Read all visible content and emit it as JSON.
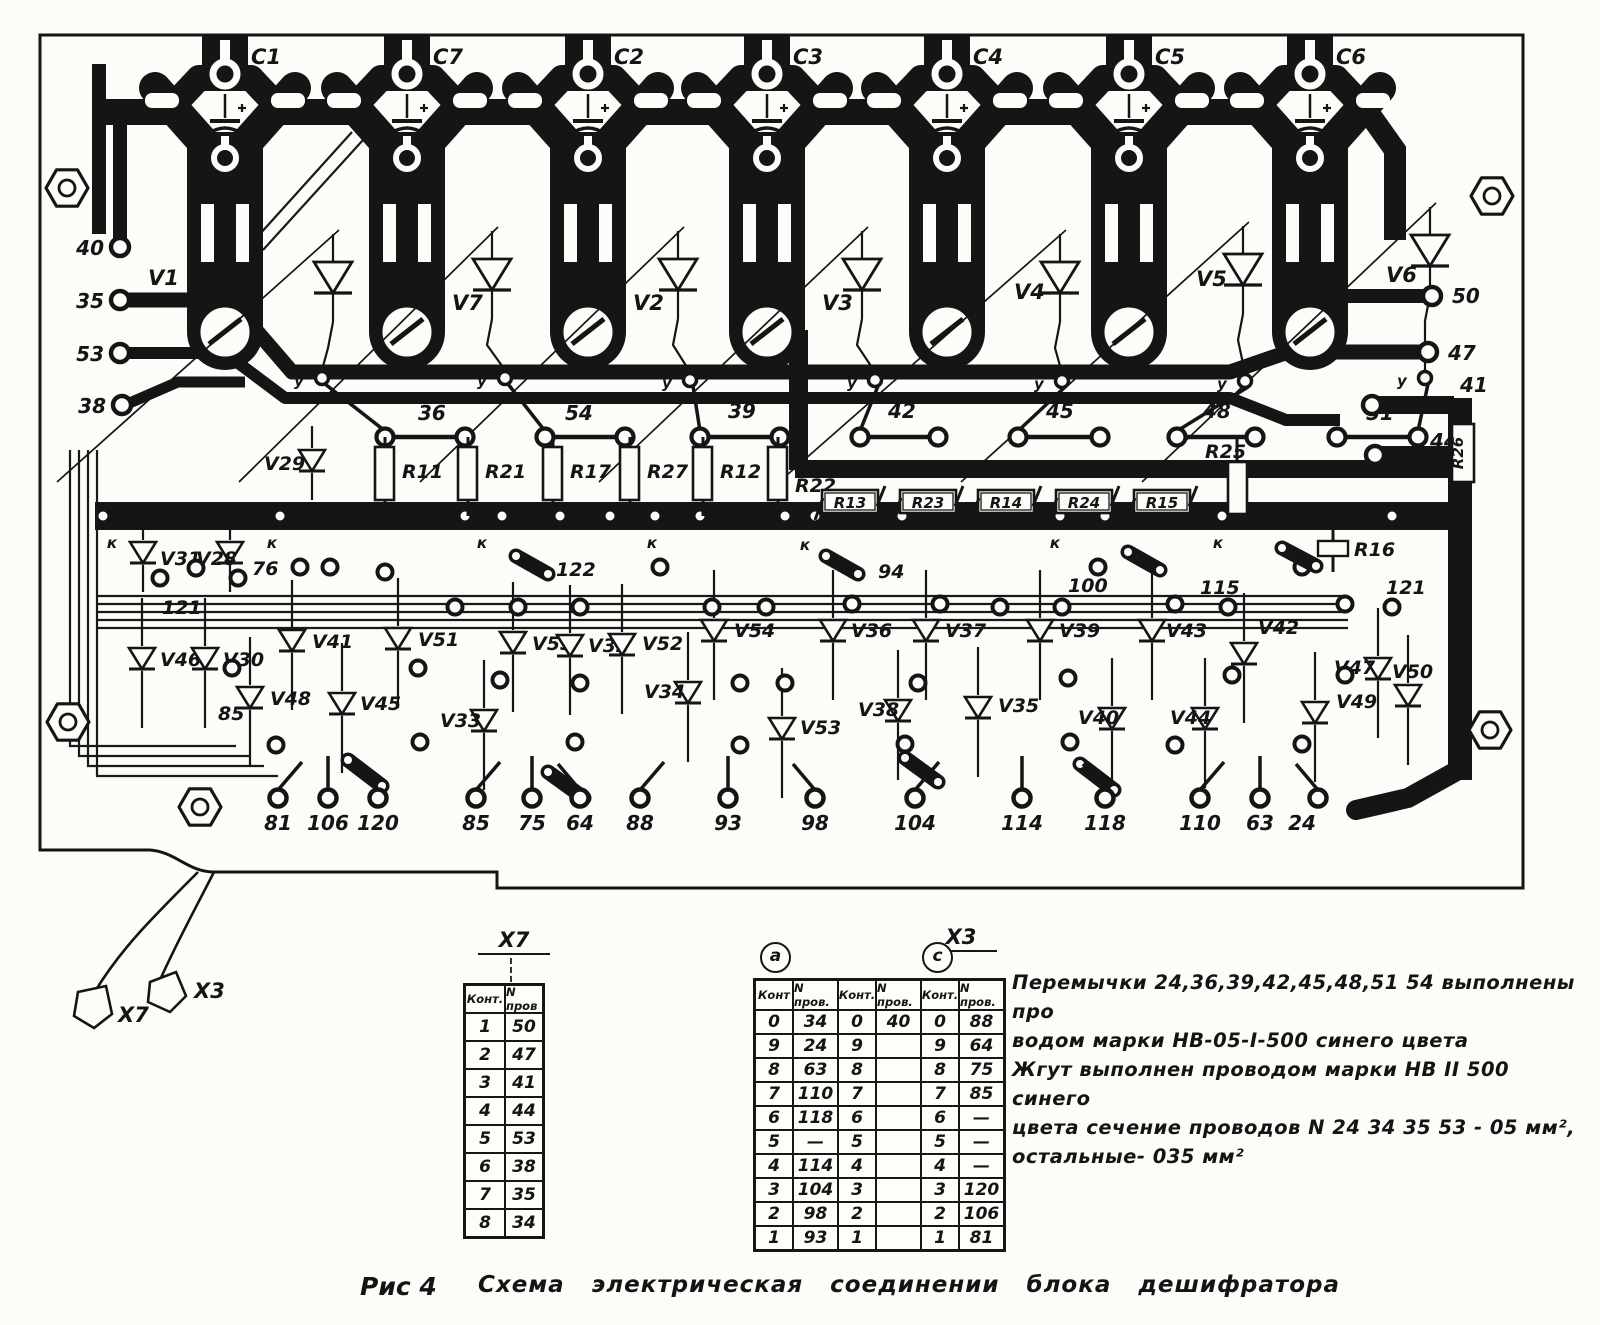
{
  "figure": {
    "fig_label": "Рис 4",
    "caption": "Схема  электрическая  соединении  блока  дешифратора"
  },
  "notes": {
    "line1": "Перемычки  24,36,39,42,45,48,51 54  выполнены  про",
    "line2": "водом  марки   НВ-05-I-500    синего   цвета",
    "line3": "Жгут  выполнен  проводом  марки  НВ II 500  синего",
    "line4": "цвета   сечение  проводов   N 24 34 35   53  - 05 мм²,",
    "line5": "остальные- 035 мм²"
  },
  "connectors": {
    "x7_flag": "X7",
    "x3_flag": "X3"
  },
  "tables": {
    "x7": {
      "title": "X7",
      "headers": [
        "Конт.",
        "N пров"
      ],
      "rows": [
        [
          "1",
          "50"
        ],
        [
          "2",
          "47"
        ],
        [
          "3",
          "41"
        ],
        [
          "4",
          "44"
        ],
        [
          "5",
          "53"
        ],
        [
          "6",
          "38"
        ],
        [
          "7",
          "35"
        ],
        [
          "8",
          "34"
        ]
      ]
    },
    "x3": {
      "title": "X3",
      "group_a": "а",
      "group_c": "с",
      "headers": [
        "Конт",
        "N пров.",
        "Конт.",
        "N пров.",
        "Конт.",
        "N пров."
      ],
      "rows": [
        [
          "0",
          "34",
          "0",
          "40",
          "0",
          "88"
        ],
        [
          "9",
          "24",
          "9",
          "",
          "9",
          "64"
        ],
        [
          "8",
          "63",
          "8",
          "",
          "8",
          "75"
        ],
        [
          "7",
          "110",
          "7",
          "",
          "7",
          "85"
        ],
        [
          "6",
          "118",
          "6",
          "",
          "6",
          "—"
        ],
        [
          "5",
          "—",
          "5",
          "",
          "5",
          "—"
        ],
        [
          "4",
          "114",
          "4",
          "",
          "4",
          "—"
        ],
        [
          "3",
          "104",
          "3",
          "",
          "3",
          "120"
        ],
        [
          "2",
          "98",
          "2",
          "",
          "2",
          "106"
        ],
        [
          "1",
          "93",
          "1",
          "",
          "1",
          "81"
        ]
      ]
    }
  },
  "board": {
    "capacitors": [
      "C1",
      "C7",
      "C2",
      "C3",
      "C4",
      "C5",
      "C6"
    ],
    "thyristors": [
      "V1",
      "V7",
      "V2",
      "V3",
      "V4",
      "V5",
      "V6"
    ],
    "edge_pads_left": [
      "40",
      "35",
      "53",
      "38"
    ],
    "edge_pads_right": [
      "50",
      "47",
      "41",
      "44"
    ],
    "gate": "у",
    "cathode": "к",
    "jumpers": [
      "36",
      "54",
      "39",
      "42",
      "45",
      "48",
      "51"
    ],
    "res_vertical": [
      "R11",
      "R21",
      "R17",
      "R27",
      "R12",
      "R22"
    ],
    "res_boxed": [
      "R13",
      "R23",
      "R14",
      "R24",
      "R15"
    ],
    "res_other": [
      "R25",
      "R26",
      "R16"
    ],
    "diodes_upper": [
      "V29",
      "V31",
      "V28"
    ],
    "diodes": [
      "V41",
      "V51",
      "V55",
      "V32",
      "V52",
      "V54",
      "V36",
      "V37",
      "V39",
      "V43",
      "V42",
      "V46",
      "V30",
      "V48",
      "V45",
      "V33",
      "V34",
      "V53",
      "V38",
      "V35",
      "V40",
      "V44",
      "V47",
      "V50",
      "V49"
    ],
    "wires": [
      "76",
      "121",
      "85",
      "122",
      "94",
      "100",
      "115",
      "121"
    ],
    "bottom_pads": [
      "81",
      "106",
      "120",
      "85",
      "75",
      "64",
      "88",
      "93",
      "98",
      "104",
      "114",
      "118",
      "110",
      "63",
      "24"
    ]
  }
}
